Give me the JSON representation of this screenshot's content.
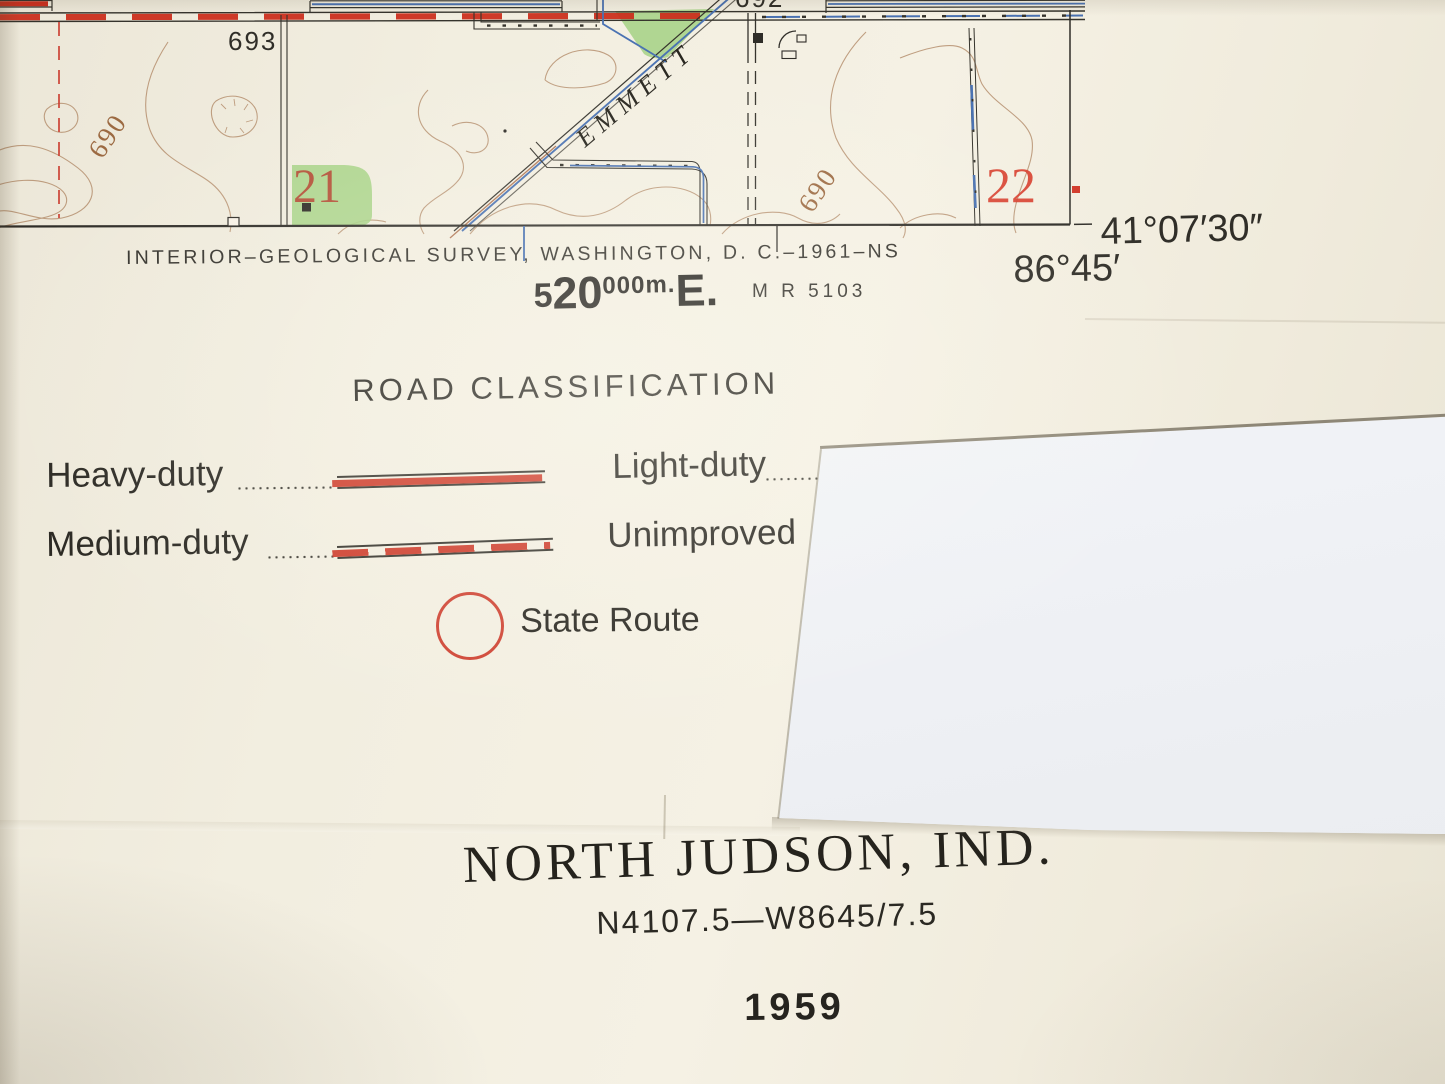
{
  "map": {
    "labels": {
      "spot_693": "693",
      "spot_692": "692",
      "contour_left": "690",
      "contour_right": "690",
      "section_21": "21",
      "section_22": "22",
      "street": "EMMETT"
    }
  },
  "margin": {
    "credit_line": "INTERIOR–GEOLOGICAL SURVEY, WASHINGTON, D. C.–1961–NS",
    "grid_easting": {
      "small_prefix": "5",
      "principal": "20",
      "small_suffix": "000m.",
      "direction": "E."
    },
    "reference_number": "M R 5103",
    "latitude": "41°07′30″",
    "longitude": "86°45′"
  },
  "legend": {
    "title": "ROAD CLASSIFICATION",
    "rows": {
      "heavy": "Heavy-duty",
      "medium": "Medium-duty",
      "light": "Light-duty",
      "unimproved": "Unimproved"
    },
    "state_route": "State Route"
  },
  "title_block": {
    "quad_name": "NORTH JUDSON, IND.",
    "designation": "N4107.5—W8645/7.5",
    "year": "1959"
  },
  "colors": {
    "road_red": "#cb2f1e",
    "water_blue": "#4a72b2",
    "woodland_green": "#a6d386",
    "contour_brown": "#b28a68",
    "ink": "#2f2d28"
  }
}
